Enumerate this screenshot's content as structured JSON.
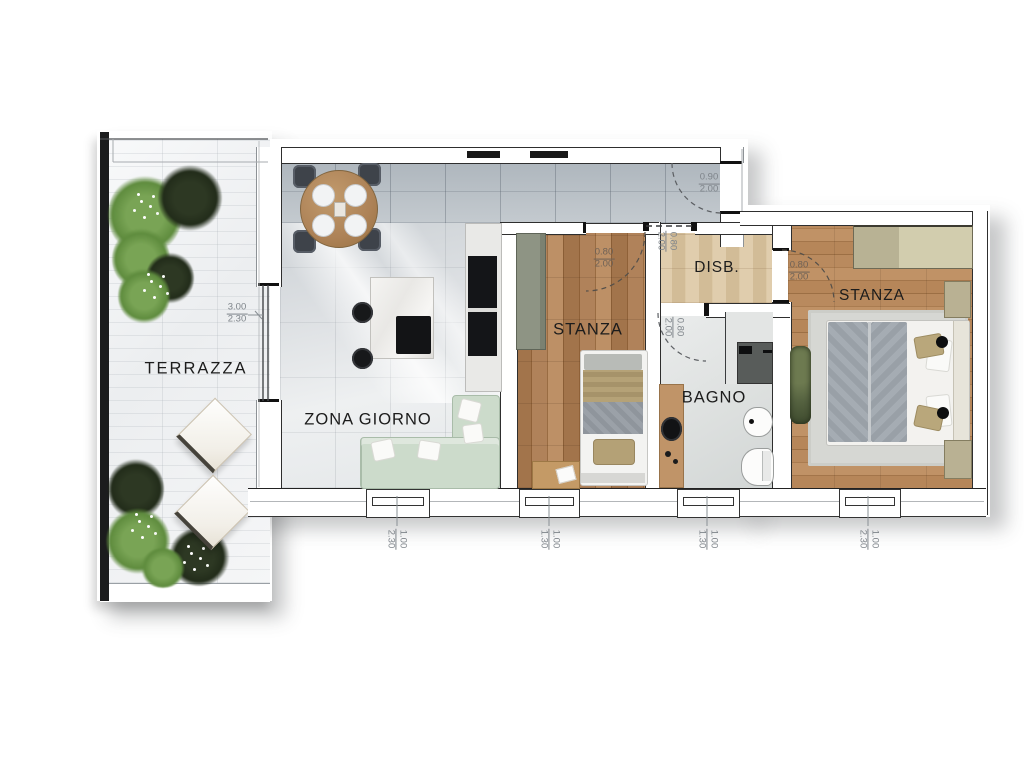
{
  "plan": {
    "rooms": {
      "terrazza": {
        "label": "TERRAZZA"
      },
      "zona_giorno": {
        "label": "ZONA GIORNO"
      },
      "stanza_left": {
        "label": "STANZA"
      },
      "disb": {
        "label": "DISB."
      },
      "bagno": {
        "label": "BAGNO"
      },
      "stanza_right": {
        "label": "STANZA"
      }
    },
    "dimensions": {
      "terrace_slider": {
        "width": "3.00",
        "height": "2.30"
      },
      "entrance_door": {
        "width": "0.90",
        "height": "2.00"
      },
      "stanza_left_door": {
        "width": "0.80",
        "height": "2.00"
      },
      "disb_door": {
        "width": "0.80",
        "height": "2.00"
      },
      "bagno_door": {
        "width": "0.80",
        "height": "2.00"
      },
      "stanza_right_door": {
        "width": "0.80",
        "height": "2.00"
      },
      "window_zona_giorno": {
        "width": "1.00",
        "height": "2.30"
      },
      "window_stanza_left": {
        "width": "1.00",
        "height": "1.30"
      },
      "window_bagno": {
        "width": "1.00",
        "height": "1.30"
      },
      "window_stanza_right": {
        "width": "1.00",
        "height": "2.30"
      }
    },
    "palette": {
      "wall_line": "#2e2e2e",
      "terrace_wall": "#1b1c1d",
      "tile_band": "#aeb6bd",
      "sofa_mint": "#ccdbcb",
      "plant_green": "#5f8c3e",
      "plant_dark": "#222c1a",
      "wood_mid": "#a87a50",
      "dim_text": "#7e848a",
      "label_text": "#1c1c1c"
    }
  }
}
